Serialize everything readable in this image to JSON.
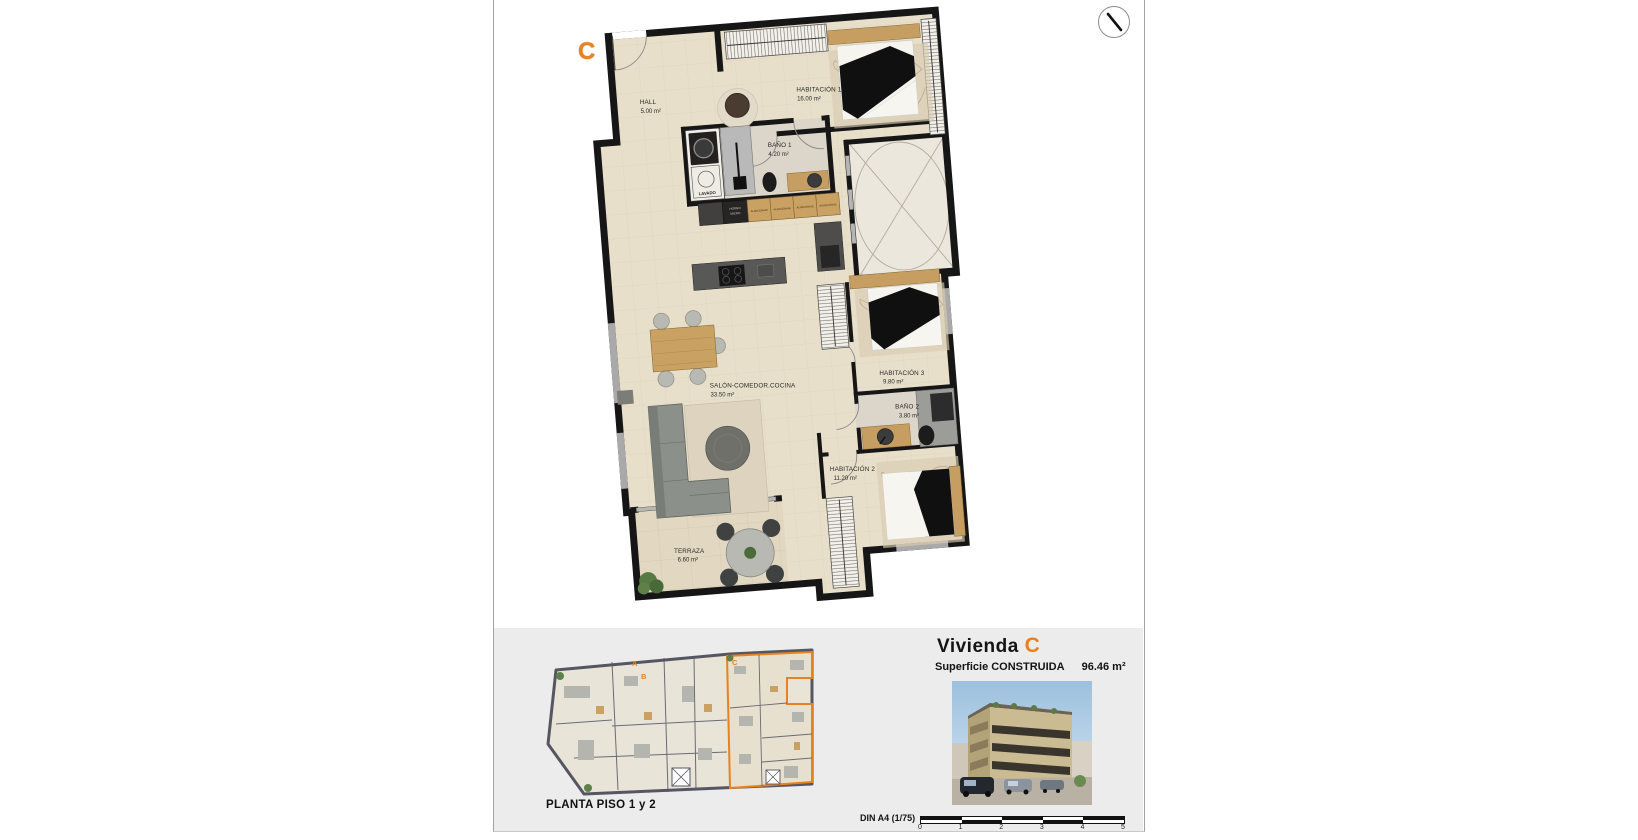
{
  "plan": {
    "unit_letter": "C",
    "rooms": [
      {
        "name": "HALL",
        "area": "5.00 m²"
      },
      {
        "name": "HABITACIÓN 1",
        "area": "16.00 m²"
      },
      {
        "name": "BAÑO 1",
        "area": "4.20 m²"
      },
      {
        "name": "SALÓN-COMEDOR.COCINA",
        "area": "33.50 m²"
      },
      {
        "name": "HABITACIÓN 3",
        "area": "9.80 m²"
      },
      {
        "name": "BAÑO 2",
        "area": "3.80 m²"
      },
      {
        "name": "HABITACIÓN 2",
        "area": "11.20 m²"
      },
      {
        "name": "TERRAZA",
        "area": "6.60 m²"
      }
    ],
    "fixtures": {
      "laundry": "LAVADO",
      "storage": "ALMACENAJE",
      "oven_top": "HORNO",
      "oven_bottom": "MICRO"
    }
  },
  "footer": {
    "overview_caption": "PLANTA PISO 1 y 2",
    "unit_labels": [
      "A",
      "B",
      "C"
    ],
    "unit_title_prefix": "Vivienda",
    "unit_letter": "C",
    "surface_label": "Superficie CONSTRUIDA",
    "surface_value": "96.46 m²",
    "scale_label": "DIN A4 (1/75)",
    "scale_ticks": [
      "0",
      "1",
      "2",
      "3",
      "4",
      "5"
    ]
  },
  "colors": {
    "accent_orange": "#e8821e",
    "wall": "#161616",
    "floor_beige": "#e8dfcb",
    "wood": "#c79e62",
    "footer_bg": "#ececec"
  }
}
